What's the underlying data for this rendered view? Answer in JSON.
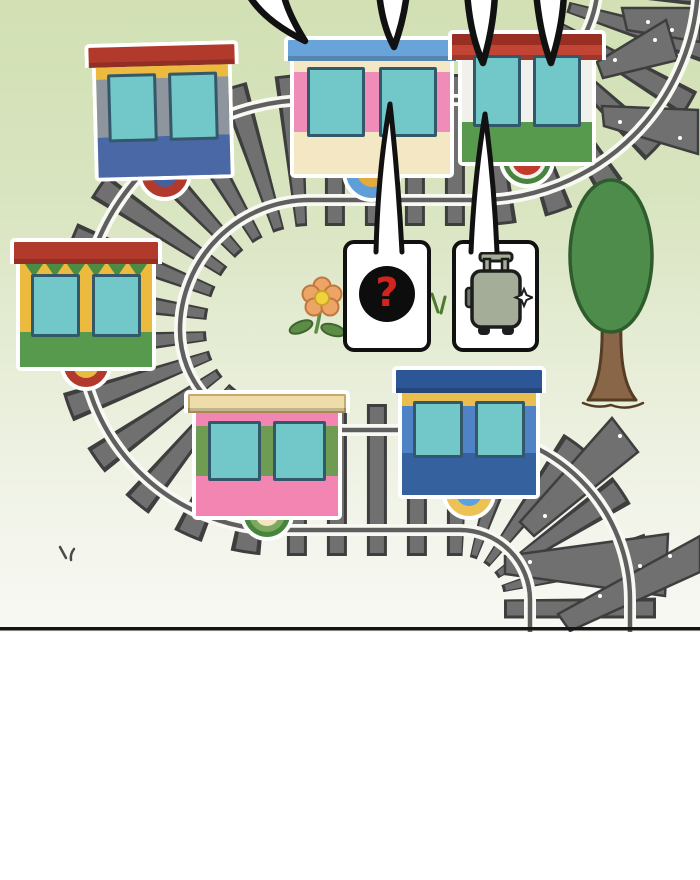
{
  "panel": {
    "type": "comic-panel-train-scene",
    "background": {
      "top": "#d2e0b4",
      "mid": "#d8e4bf",
      "lower": "#e8eed9",
      "near_line": "#f3f5ec",
      "bottom": "#f8f9f3",
      "divider": "#161616",
      "gutter": "#ffffff"
    },
    "track": {
      "sleeper": "#707070",
      "sleeper_edge": "#3e3e3e",
      "sleeper_dot": "#ffffff",
      "rail": "#5f5f5f",
      "rail_casing": "#f8f9f3"
    },
    "tree": {
      "canopy": "#4e8c4c",
      "canopy_edge": "#2f5c2c",
      "trunk": "#8a6648",
      "trunk_edge": "#553c24"
    },
    "flower": {
      "petal": "#eda565",
      "petal_edge": "#c07840",
      "center": "#f2d23c",
      "center_edge": "#caa52c",
      "leaf": "#5d8c46",
      "leaf_edge": "#3f6530"
    },
    "grass": {
      "green": "#4e7a30",
      "dark": "#4a4a4a"
    },
    "windows": {
      "fill": "#72c8c8",
      "border": "#33586a"
    },
    "bubbles": {
      "question": {
        "fill": "#ffffff",
        "border": "#111111",
        "circle": "#0d0d0d",
        "mark": "?",
        "mark_color": "#d2241e"
      },
      "suitcase": {
        "fill": "#ffffff",
        "border": "#111111",
        "icon": "suitcase-icon",
        "body": "#a3ad97",
        "tab": "#6f7a66",
        "dark": "#1d1d1d",
        "sparkle": "#ffffff"
      }
    },
    "tails": {
      "fill": "#ffffff",
      "outline": "#111111"
    },
    "cars": [
      {
        "id": "car-top-left",
        "x": 93,
        "y": 42,
        "w": 140,
        "rot": -1.5,
        "roof": {
          "color": "#b23a2c",
          "h": 20,
          "ov": 7
        },
        "bands": [
          {
            "k": "plain",
            "c": "#ecba3e",
            "h": 12
          },
          {
            "k": "win",
            "c": "#8e959c",
            "h": 58
          },
          {
            "k": "plain",
            "c": "#4a68a6",
            "h": 40
          }
        ],
        "wheel": {
          "r": 27,
          "c": "#b23a2c",
          "hub": "#44609e",
          "hubr": 13
        }
      },
      {
        "id": "car-pink-top",
        "x": 290,
        "y": 36,
        "w": 164,
        "rot": 0,
        "roof": {
          "color": "#68a4da",
          "h": 21,
          "ov": 6
        },
        "bands": [
          {
            "k": "plain",
            "c": "#f4e7c4",
            "h": 11
          },
          {
            "k": "win",
            "c": "#f08cb8",
            "h": 60
          },
          {
            "k": "plain",
            "c": "#f4e7c4",
            "h": 42
          }
        ],
        "wheel": {
          "r": 30,
          "c": "#5f9fd8",
          "hub": "#e2ab41",
          "hubr": 15
        }
      },
      {
        "id": "car-green-top",
        "x": 458,
        "y": 30,
        "w": 138,
        "rot": 0,
        "roof": {
          "color": "#c14434",
          "color2": "#992e22",
          "h": 26,
          "ov": 10
        },
        "bands": [
          {
            "k": "win",
            "c": "#f0f1ec",
            "h": 62
          },
          {
            "k": "plain",
            "c": "#579a4e",
            "h": 40
          }
        ],
        "wheel": {
          "r": 28,
          "c": "#f0f1ec",
          "ring": "#47853d",
          "hub": "#c1392a",
          "hubr": 15
        }
      },
      {
        "id": "car-bunting",
        "x": 16,
        "y": 238,
        "w": 140,
        "rot": 0,
        "roof": {
          "color": "#b23a2c",
          "h": 22,
          "ov": 6
        },
        "bands": [
          {
            "k": "bunt",
            "c": "#ecba3e",
            "h": 15,
            "tri": "#4c8b42"
          },
          {
            "k": "win",
            "c": "#ecba3e",
            "h": 53
          },
          {
            "k": "plain",
            "c": "#579a4e",
            "h": 35
          }
        ],
        "wheel": {
          "r": 26,
          "c": "#b23a2c",
          "hub": "#e8bb42",
          "hubr": 13
        }
      },
      {
        "id": "car-pink-bottom",
        "x": 192,
        "y": 390,
        "w": 150,
        "rot": 0,
        "roof": {
          "color": "#eedcab",
          "h": 19,
          "ov": 8,
          "edge": "#c9a96b"
        },
        "bands": [
          {
            "k": "plain",
            "c": "#f285b2",
            "h": 13
          },
          {
            "k": "win",
            "c": "#6d9c52",
            "h": 50
          },
          {
            "k": "plain",
            "c": "#f285b2",
            "h": 40
          }
        ],
        "wheel": {
          "r": 27,
          "c": "#7ca95f",
          "ring": "#47853d",
          "hub": "#f2e5bd",
          "hubr": 12
        }
      },
      {
        "id": "car-blue-bottom",
        "x": 398,
        "y": 366,
        "w": 142,
        "rot": 0,
        "roof": {
          "color": "#2d5696",
          "h": 23,
          "ov": 6
        },
        "bands": [
          {
            "k": "plain",
            "c": "#e9bd4e",
            "h": 13
          },
          {
            "k": "win",
            "c": "#4f83c6",
            "h": 47
          },
          {
            "k": "plain",
            "c": "#35629f",
            "h": 42
          }
        ],
        "wheel": {
          "r": 27,
          "c": "#edc254",
          "hub": "#5ba2de",
          "hubr": 13
        }
      }
    ]
  }
}
